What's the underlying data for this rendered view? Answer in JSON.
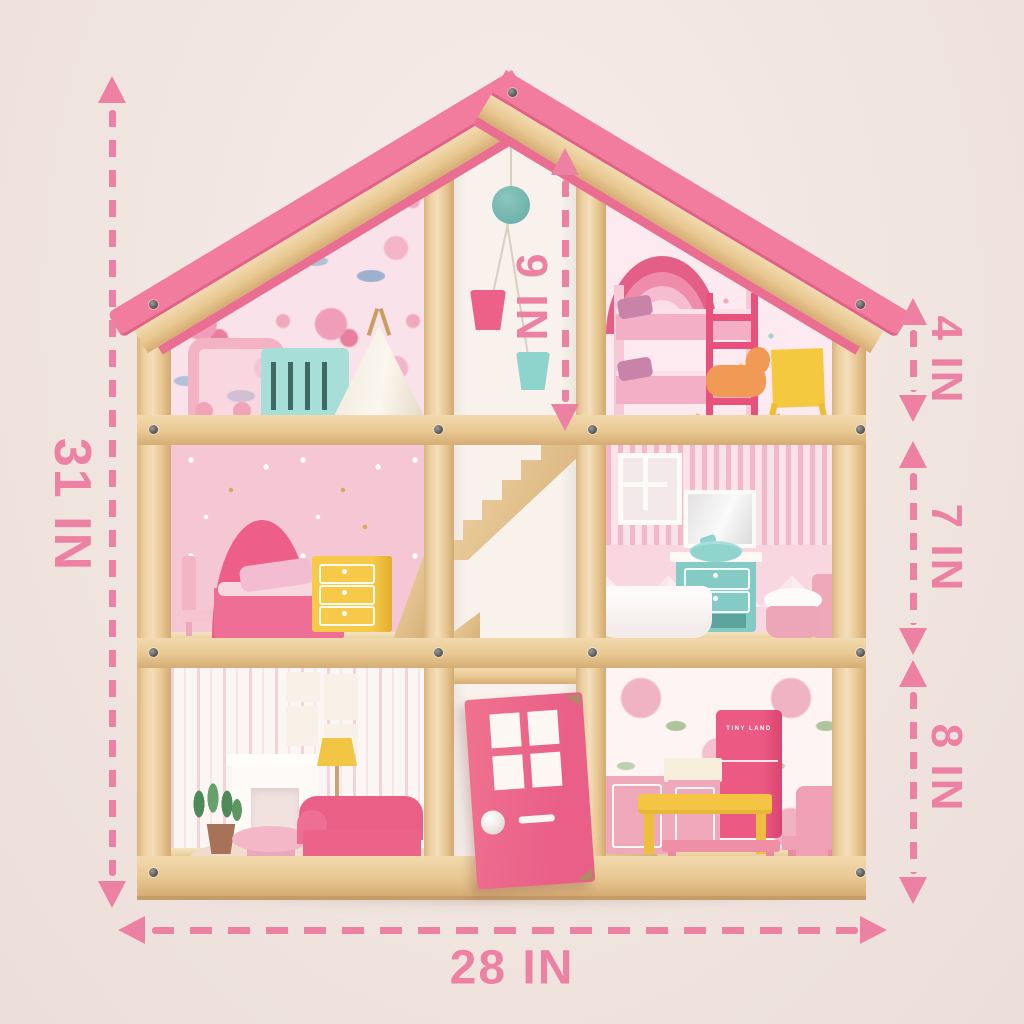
{
  "scene": {
    "type": "product dimension illustration",
    "subject": "wooden dollhouse with pink roof, three floors and six furnished rooms",
    "background_color": "#f1e6e2"
  },
  "annotations": {
    "color": "#ec81a3",
    "overall_height": "31 IN",
    "overall_width": "28 IN",
    "attic_height": "9 IN",
    "top_floor_height": "4 IN",
    "middle_floor_height": "7 IN",
    "ground_floor_height": "8 IN"
  },
  "house": {
    "fridge_brand": "TINY LAND",
    "palette": {
      "roof_pink": "#f17c9d",
      "roof_edge": "#e06289",
      "wood": "#eccfa0",
      "door_pink": "#ee6a91",
      "fridge_pink": "#e64f7b",
      "teal": "#8fd2cb",
      "yellow": "#f4c544",
      "annotation_pink": "#ec81a3"
    }
  }
}
